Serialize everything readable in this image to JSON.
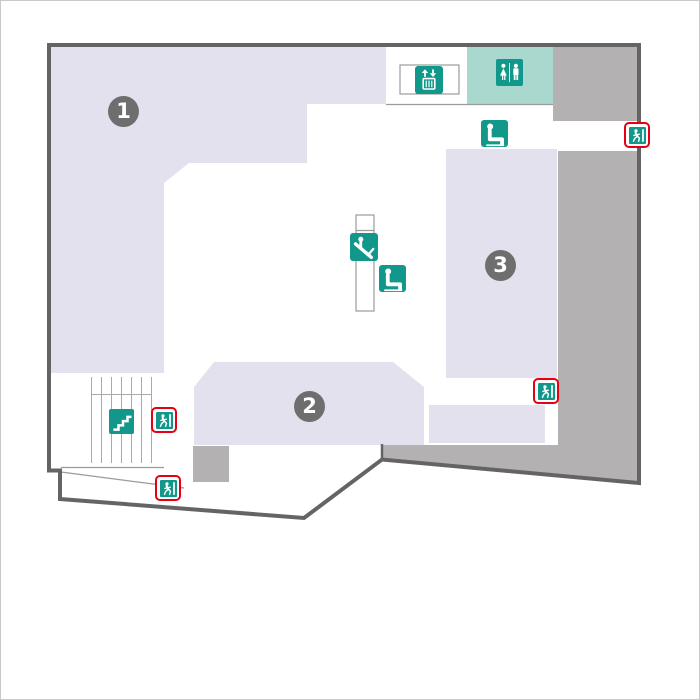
{
  "map": {
    "name": "floor-guide-map",
    "areas": [
      {
        "id": "area-1",
        "label": "1"
      },
      {
        "id": "area-2",
        "label": "2"
      },
      {
        "id": "area-3",
        "label": "3"
      }
    ],
    "facilities": [
      {
        "id": "elevator",
        "icon": "elevator-icon",
        "count": 1
      },
      {
        "id": "restroom",
        "icon": "toilet-icon",
        "count": 1
      },
      {
        "id": "resting-seat",
        "icon": "seat-icon",
        "count": 2
      },
      {
        "id": "escalator",
        "icon": "escalator-icon",
        "count": 1
      },
      {
        "id": "stairs",
        "icon": "stairs-icon",
        "count": 1
      },
      {
        "id": "emergency-exit",
        "icon": "emergency-exit-icon",
        "count": 4
      }
    ],
    "colors": {
      "sales_area_fill": "#e3e1ed",
      "facility_teal": "#12988b",
      "restroom_bg": "#a9d8cf",
      "wall_fill_gray": "#b3b1b2",
      "outline_gray": "#666364",
      "area_badge_gray": "#6e6e6e",
      "exit_frame_red": "#e60012",
      "thin_line_gray": "#9b9b9b"
    }
  }
}
